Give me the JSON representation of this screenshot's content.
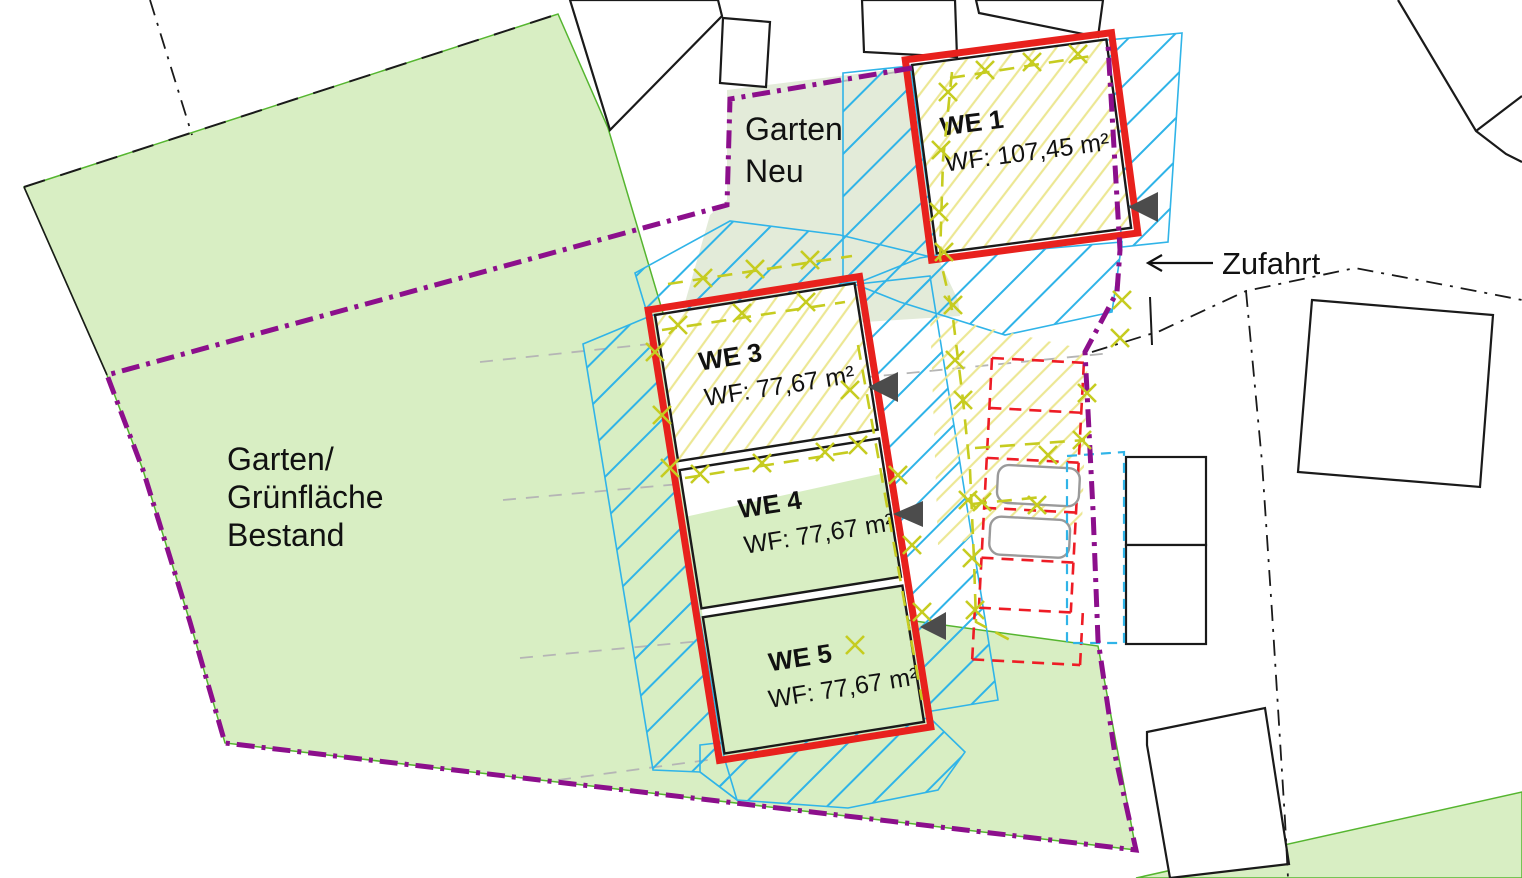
{
  "plan": {
    "areas": {
      "garten_neu": {
        "line1": "Garten",
        "line2": "Neu"
      },
      "garten_bestand": {
        "line1": "Garten/",
        "line2": "Grünfläche",
        "line3": "Bestand"
      }
    },
    "units": {
      "we1": {
        "name": "WE 1",
        "area": "WF: 107,45 m²"
      },
      "we3": {
        "name": "WE 3",
        "area": "WF: 77,67 m²"
      },
      "we4": {
        "name": "WE 4",
        "area": "WF: 77,67 m²"
      },
      "we5": {
        "name": "WE 5",
        "area": "WF: 77,67 m²"
      }
    },
    "annotations": {
      "zufahrt": "Zufahrt"
    },
    "colors": {
      "green_area": "#d8eec3",
      "green_edge": "#55b52f",
      "garten_neu_area": "#e3ebd9",
      "site_boundary_purple": "#8c0f8c",
      "building_red": "#e8211d",
      "parking_red_dashed": "#ee1c25",
      "hatch_blue": "#30b4e8",
      "hatch_yellow": "#ece794",
      "marker_olive": "#c6cc20",
      "leader_gray": "#b5b5b5",
      "entrance_triangle": "#4c4c4c",
      "outline_black": "#111111"
    }
  }
}
